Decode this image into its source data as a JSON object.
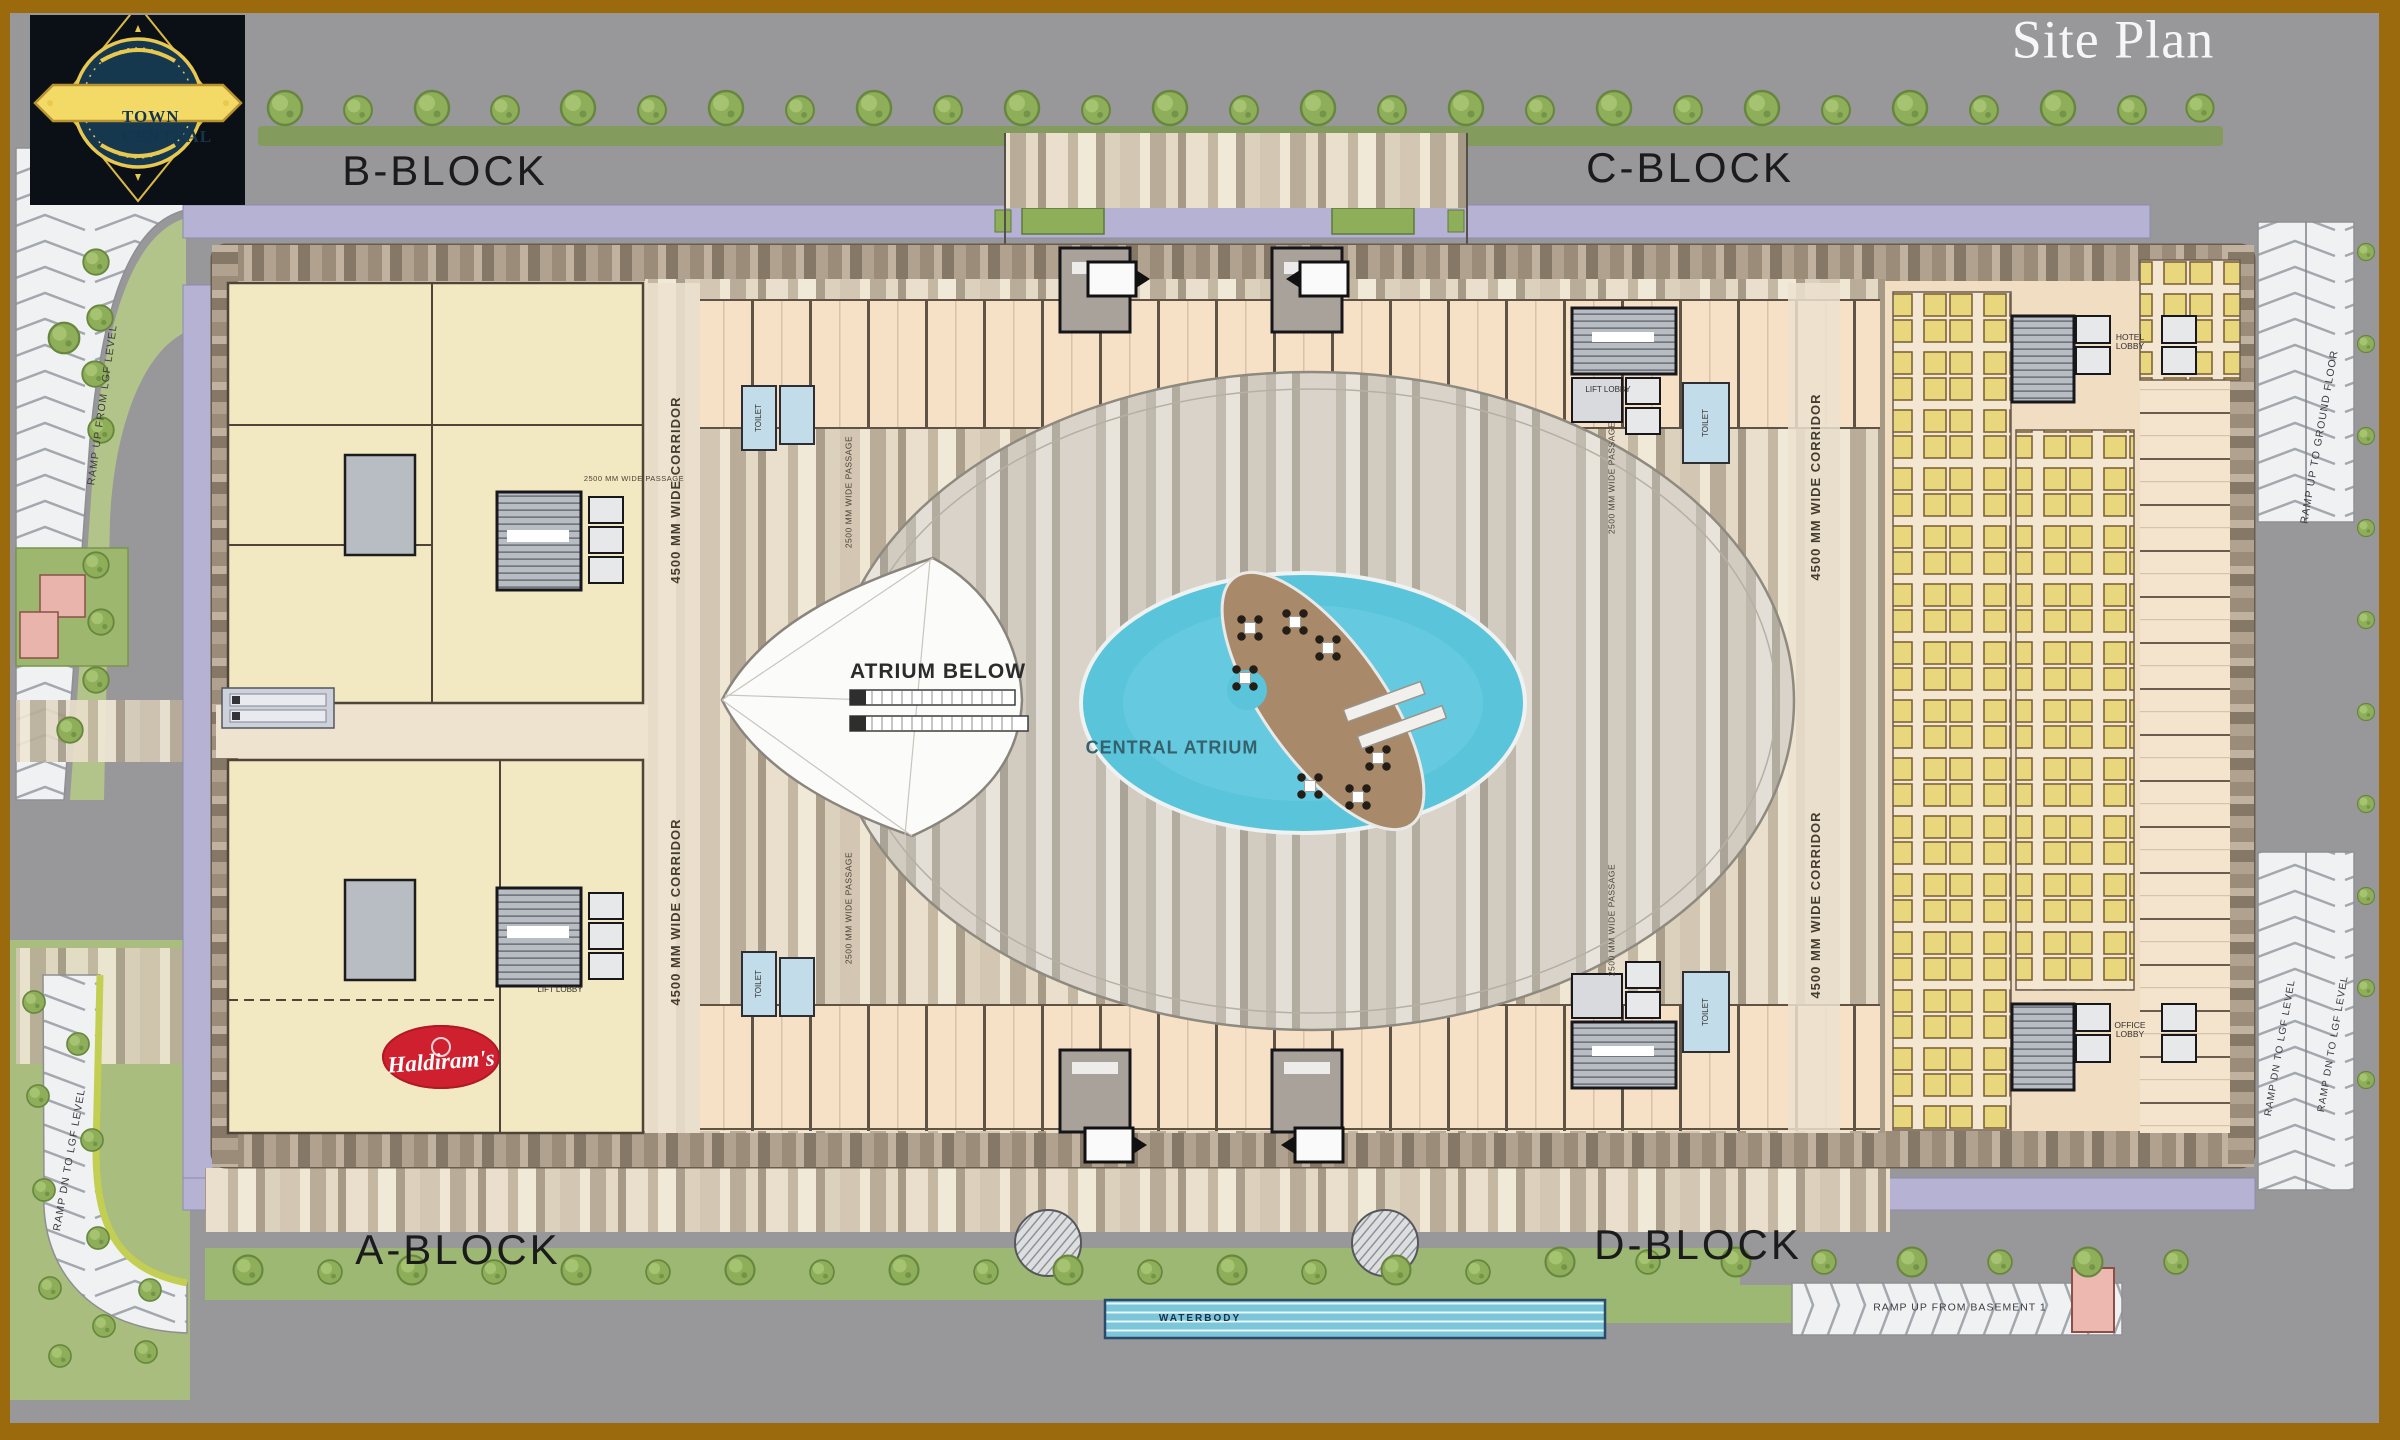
{
  "header": {
    "brand": "TOWN CENTRAL",
    "title": "Site Plan"
  },
  "blocks": {
    "b": "B-BLOCK",
    "c": "C-BLOCK",
    "a": "A-BLOCK",
    "d": "D-BLOCK"
  },
  "plan_labels": {
    "atrium_below": "ATRIUM BELOW",
    "central_atrium": "CENTRAL ATRIUM",
    "waterbody": "WATERBODY",
    "corridor": "4500 MM WIDE CORRIDOR",
    "passage": "2500 MM WIDE PASSAGE",
    "toilet": "TOILET",
    "hotel_lobby": "HOTEL LOBBY",
    "office_lobby": "OFFICE LOBBY",
    "lift_lobby": "LIFT LOBBY"
  },
  "tenants": {
    "haldirams": "Haldiram's"
  },
  "ramps": {
    "up_from_lgf": "RAMP UP FROM LGF LEVEL",
    "dn_to_lgf": "RAMP DN TO LGF LEVEL",
    "up_to_ground": "RAMP UP TO GROUND FLOOR",
    "up_from_basement": "RAMP UP FROM BASEMENT 1"
  },
  "colors": {
    "frame": "#9a6a0c",
    "background": "#98979a",
    "road": "#b6b2d4",
    "grass": "#aabf7e",
    "water": "#5ac4da",
    "island": "#a8896a",
    "anchor_unit": "#f2e9c2",
    "shop_unit": "#f7e1c6",
    "accent_red": "#cf2030",
    "logo_gold": "#e9c84f",
    "logo_navy": "#14354e"
  }
}
